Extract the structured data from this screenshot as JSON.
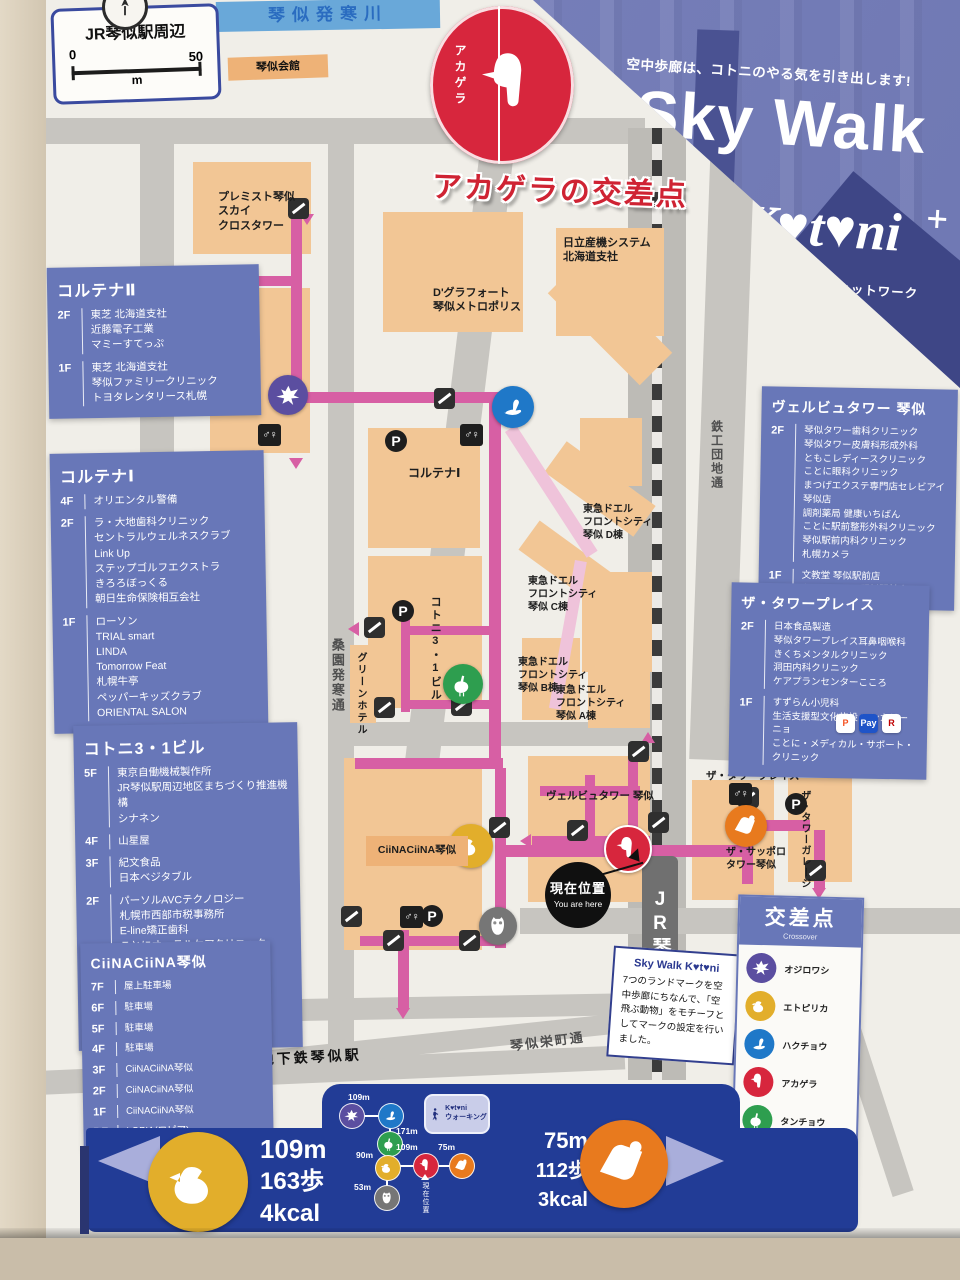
{
  "header": {
    "area_title": "JR琴似駅周辺",
    "scale": {
      "zero": "0",
      "fifty": "50",
      "unit": "m"
    },
    "river": "琴似発寒川",
    "kotoni_kaikan": "琴似会館"
  },
  "banner": {
    "tagline": "空中歩廊は、コトニのやる気を引き出します!",
    "title": "Sky Walk",
    "brand": "K♥t♥ni",
    "subtitle": "空中歩廊ネットワーク"
  },
  "crossing": {
    "mark": "アカゲラ",
    "headline": "アカゲラの交差点"
  },
  "map": {
    "station": "JR琴似駅",
    "you_are_here": {
      "ja": "現在位置",
      "en": "You are here"
    },
    "streets": {
      "soen": "桑園発寒通",
      "sakaemachi": "琴似栄町通",
      "tekko": "鉄工団地通",
      "subway": "◀至 地下鉄琴似駅"
    }
  },
  "buildings": {
    "premist": "プレミスト琴似\nスカイ\nクロスタワー",
    "hitachi": "日立産機システム\n北海道支社",
    "dgrafort": "D'グラフォート\n琴似メトロポリス",
    "cortina1": "コルテナⅠ",
    "cortina2": "コルテナⅡ",
    "tokyu_d": "東急ドエル\nフロントシティ\n琴似 D棟",
    "tokyu_c": "東急ドエル\nフロントシティ\n琴似 C棟",
    "tokyu_b": "東急ドエル\nフロントシティ\n琴似 B棟",
    "tokyu_a": "東急ドエル\nフロントシティ\n琴似 A棟",
    "kotoni31": "コトニ3・1ビル",
    "greenhotel": "グリーンホテル",
    "velbu": "ヴェルビュタワー 琴似",
    "clina": "CiiNACiiNA琴似",
    "towerplace": "ザ・タワープレイス",
    "sapporotower": "ザ・サッポロ\nタワー琴似",
    "towergarage": "ザ・タワーガレージ"
  },
  "directories": [
    {
      "name": "コルテナⅡ",
      "floors": [
        {
          "f": "2F",
          "t": [
            "東芝 北海道支社",
            "近藤電子工業",
            "マミーすてっぷ"
          ]
        },
        {
          "f": "1F",
          "t": [
            "東芝 北海道支社",
            "琴似ファミリークリニック",
            "トヨタレンタリース札幌"
          ]
        }
      ]
    },
    {
      "name": "コルテナⅠ",
      "floors": [
        {
          "f": "4F",
          "t": [
            "オリエンタル警備"
          ]
        },
        {
          "f": "2F",
          "t": [
            "ラ・大地歯科クリニック",
            "セントラルウェルネスクラブ",
            "Link Up",
            "ステップゴルフエクストラ",
            "きろろぼっくる",
            "朝日生命保険相互会社"
          ]
        },
        {
          "f": "1F",
          "t": [
            "ローソン",
            "TRIAL smart",
            "LINDA",
            "Tomorrow Feat",
            "札幌牛亭",
            "ペッパーキッズクラブ",
            "ORIENTAL SALON"
          ]
        }
      ]
    },
    {
      "name": "コトニ3・1ビル",
      "floors": [
        {
          "f": "5F",
          "t": [
            "東京自働機械製作所",
            "JR琴似駅周辺地区まちづくり推進機構",
            "シナネン"
          ]
        },
        {
          "f": "4F",
          "t": [
            "山星屋"
          ]
        },
        {
          "f": "3F",
          "t": [
            "紀文食品",
            "日本ベジタブル"
          ]
        },
        {
          "f": "2F",
          "t": [
            "パーソルAVCテクノロジー",
            "札幌市西部市税事務所",
            "E-line矯正歯科",
            "ことにオーラルケアクリニック",
            "ホームズ",
            "YKKAP"
          ]
        },
        {
          "f": "1F",
          "t": [
            "琴似グリーンホテル",
            "ホットヨガスタジオLAVA",
            "ヒビノ"
          ]
        }
      ]
    },
    {
      "name": "CiiNACiiNA琴似",
      "floors": [
        {
          "f": "7F",
          "t": [
            "屋上駐車場"
          ]
        },
        {
          "f": "6F",
          "t": [
            "駐車場"
          ]
        },
        {
          "f": "5F",
          "t": [
            "駐車場"
          ]
        },
        {
          "f": "4F",
          "t": [
            "駐車場"
          ]
        },
        {
          "f": "3F",
          "t": [
            "CiiNACiiNA琴似"
          ]
        },
        {
          "f": "2F",
          "t": [
            "CiiNACiiNA琴似"
          ]
        },
        {
          "f": "1F",
          "t": [
            "CiiNACiiNA琴似"
          ]
        },
        {
          "f": "BF",
          "t": [
            "LOPIA(ロピア)"
          ]
        }
      ]
    },
    {
      "name": "ヴェルビュタワー 琴似",
      "floors": [
        {
          "f": "2F",
          "t": [
            "琴似タワー歯科クリニック",
            "琴似タワー皮膚科形成外科",
            "ともこレディースクリニック",
            "ことに眼科クリニック",
            "まつげエクステ専門店セレビアイ琴似店",
            "調剤薬局 健康いちばん",
            "ことに駅前整形外科クリニック",
            "琴似駅前内科クリニック",
            "札幌カメラ"
          ]
        },
        {
          "f": "1F",
          "t": [
            "文教堂 琴似駅前店",
            "キャン★ドゥ 琴似駅前店"
          ]
        }
      ]
    },
    {
      "name": "ザ・タワープレイス",
      "floors": [
        {
          "f": "2F",
          "t": [
            "日本食品製造",
            "琴似タワープレイス耳鼻咽喉科",
            "きくちメンタルクリニック",
            "洞田内科クリニック",
            "ケアプランセンターこころ"
          ]
        },
        {
          "f": "1F",
          "t": [
            "すずらん小児科",
            "生活支援型文化施設 コンカリーニョ",
            "ことに・メディカル・サポート・クリニック"
          ]
        }
      ]
    }
  ],
  "payments": [
    {
      "glyph": "P",
      "fg": "#f54f1e",
      "bg": "#ffffff"
    },
    {
      "glyph": "Pay",
      "fg": "#ffffff",
      "bg": "#1f54c8"
    },
    {
      "glyph": "R",
      "fg": "#bf0000",
      "bg": "#ffffff"
    }
  ],
  "legend": {
    "title": "交差点",
    "subtitle": "Crossover",
    "items": [
      {
        "name": "オジロワシ",
        "color": "#5b4ea0",
        "icon": "eagle"
      },
      {
        "name": "エトピリカ",
        "color": "#e2ae2b",
        "icon": "puffin"
      },
      {
        "name": "ハクチョウ",
        "color": "#1f78c8",
        "icon": "swan"
      },
      {
        "name": "アカゲラ",
        "color": "#d7263d",
        "icon": "woodpecker"
      },
      {
        "name": "タンチョウ",
        "color": "#2e9e4f",
        "icon": "crane"
      },
      {
        "name": "エゾモモンガ",
        "color": "#e87a1e",
        "icon": "squirrel"
      },
      {
        "name": "エゾシマフクロウ",
        "color": "#767676",
        "icon": "owl"
      }
    ]
  },
  "note": {
    "title": "Sky Walk K♥t♥ni",
    "body": "7つのランドマークを空中歩廊にちなんで、「空飛ぶ動物」をモチーフとしてマークの設定を行いました。"
  },
  "footer": {
    "left": {
      "distance": "109m",
      "steps": "163歩",
      "kcal": "4kcal"
    },
    "right": {
      "distance": "75m",
      "steps": "112歩",
      "kcal": "3kcal"
    },
    "badge": "K♥t♥ni\nウォーキング",
    "you_are_here": "現在位置",
    "segments": {
      "d1": "109m",
      "d2": "171m",
      "d3": "90m",
      "d4": "109m",
      "d5": "75m",
      "d6": "53m"
    }
  }
}
